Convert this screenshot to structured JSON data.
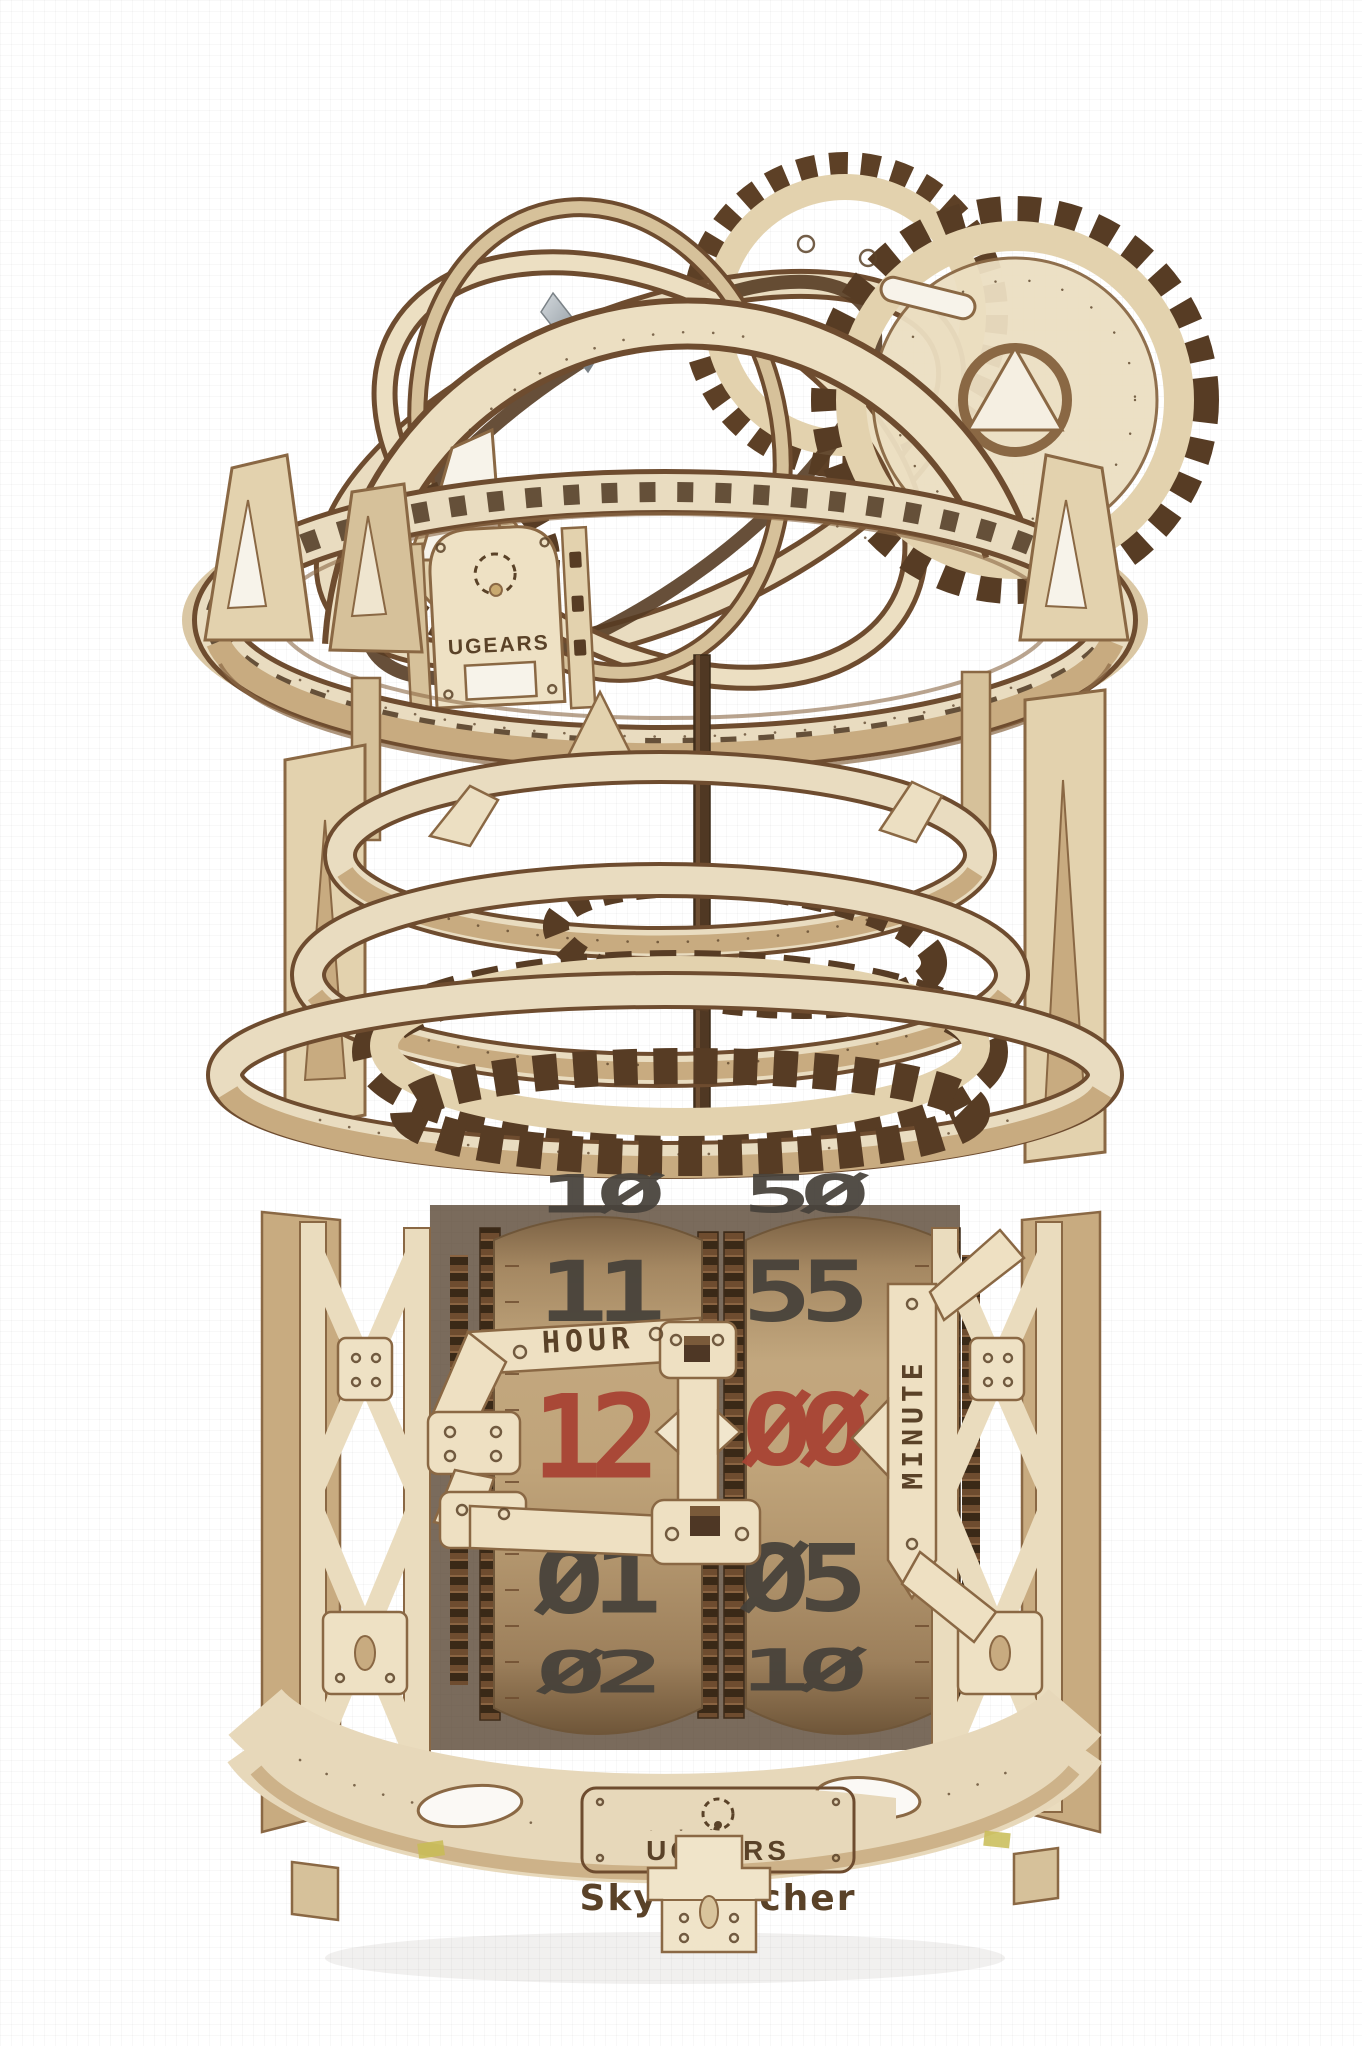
{
  "photo": {
    "subject": "UGEARS Sky Watcher wooden mechanical tourbillon table clock model",
    "scene": "product photo of laser-cut plywood model on plain white background",
    "background_color": "#ffffff"
  },
  "branding": {
    "logo_plate_top": "UGEARS",
    "logo_plate_base": "UGEARS",
    "model_name": "Sky Watcher"
  },
  "time_display": {
    "hour_label": "HOUR",
    "minute_label": "MINUTE",
    "hour_drum": [
      "1Ø",
      "11",
      "12",
      "Ø1",
      "Ø2"
    ],
    "minute_drum": [
      "5Ø",
      "55",
      "ØØ",
      "Ø5",
      "1Ø"
    ],
    "current_hour": "12",
    "current_minute": "ØØ",
    "current_digit_color": "#a84434",
    "drum_digit_color": "#46413a"
  },
  "materials": {
    "plywood_light": "#ecdfc2",
    "plywood_mid": "#d6c19a",
    "plywood_tan": "#c8ab80",
    "burnt_edge": "#6e4c2f",
    "drum_kraft": "#b4976f",
    "engraving_brown": "#5a4228",
    "metal_spring": "#aeb6bb"
  }
}
